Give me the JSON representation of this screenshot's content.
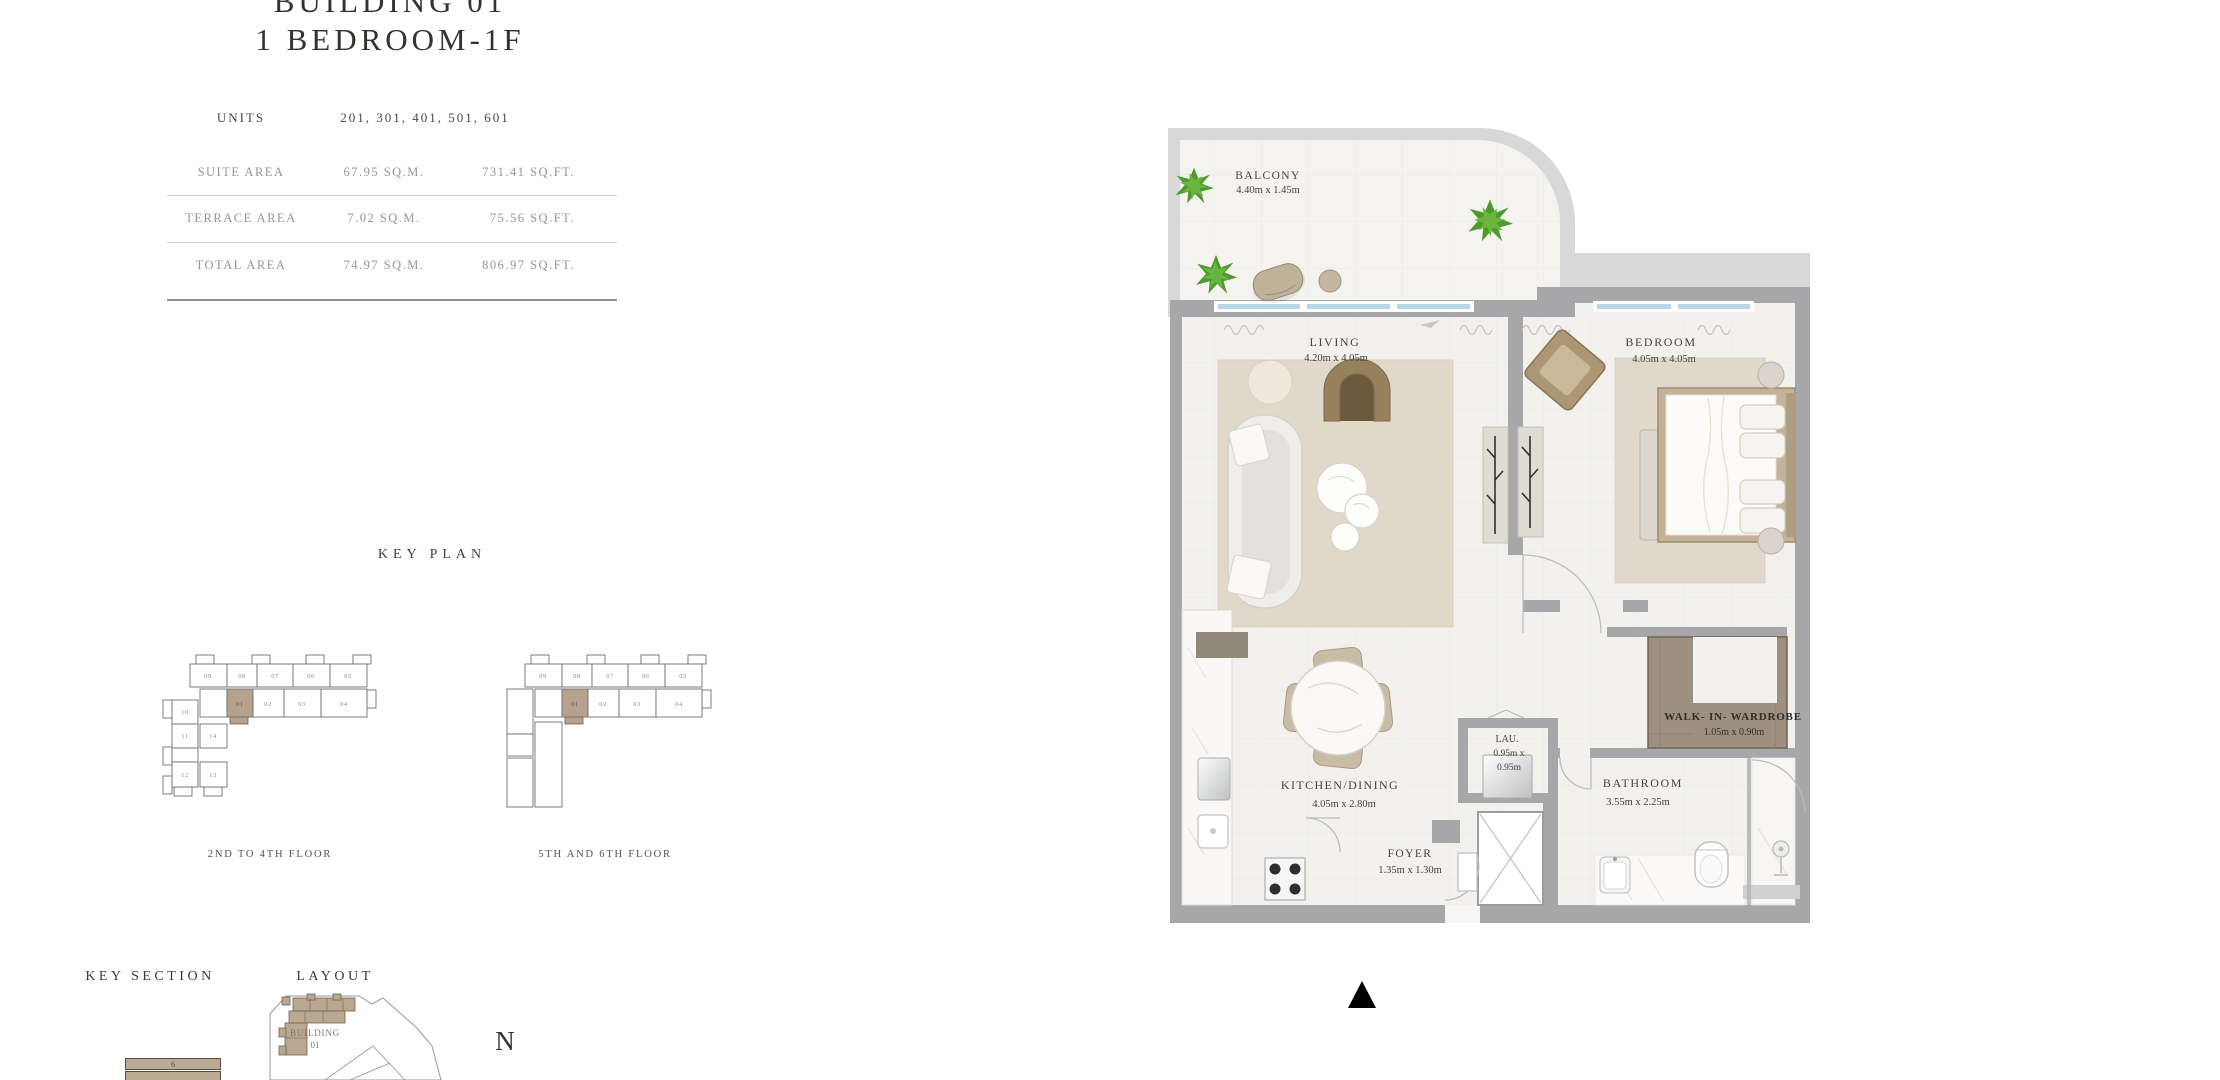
{
  "page": {
    "title_line1": "BUILDING 01",
    "title_line2": "1 BEDROOM-1F",
    "compass": "N"
  },
  "area_table": {
    "units_label": "UNITS",
    "units_value": "201, 301, 401, 501, 601",
    "rows": [
      {
        "label": "SUITE AREA",
        "sqm": "67.95 SQ.M.",
        "sqft": "731.41 SQ.FT."
      },
      {
        "label": "TERRACE AREA",
        "sqm": "7.02 SQ.M.",
        "sqft": "75.56 SQ.FT."
      },
      {
        "label": "TOTAL AREA",
        "sqm": "74.97 SQ.M.",
        "sqft": "806.97 SQ.FT."
      }
    ]
  },
  "key_plan": {
    "title": "KEY PLAN",
    "highlight_color": "#b5a28c",
    "plans": [
      {
        "caption": "2ND TO 4TH FLOOR",
        "top_units": [
          "09",
          "08",
          "07",
          "06",
          "05"
        ],
        "mid_units": [
          "01",
          "02",
          "03",
          "04"
        ],
        "side_units": [
          "10",
          "11",
          "12",
          "14",
          "13"
        ],
        "highlighted_unit": "01"
      },
      {
        "caption": "5TH AND 6TH FLOOR",
        "top_units": [
          "09",
          "08",
          "07",
          "06",
          "05"
        ],
        "mid_units": [
          "01",
          "02",
          "03",
          "04"
        ],
        "highlighted_unit": "01"
      }
    ]
  },
  "key_section": {
    "title": "KEY SECTION",
    "bar_label": "6"
  },
  "layout": {
    "title": "LAYOUT",
    "building_label": "BUILDING",
    "building_number": "01"
  },
  "floor_plan": {
    "rooms": {
      "balcony": {
        "name": "BALCONY",
        "dims": "4.40m x 1.45m"
      },
      "living": {
        "name": "LIVING",
        "dims": "4.20m x 4.05m"
      },
      "bedroom": {
        "name": "BEDROOM",
        "dims": "4.05m x 4.05m"
      },
      "wardrobe": {
        "name": "WALK- IN- WARDROBE",
        "dims": "1.05m x 0.90m"
      },
      "laundry": {
        "name": "LAU.",
        "dims1": "0.95m x",
        "dims2": "0.95m"
      },
      "kitchen": {
        "name": "KITCHEN/DINING",
        "dims": "4.05m x 2.80m"
      },
      "bathroom": {
        "name": "BATHROOM",
        "dims": "3.55m x 2.25m"
      },
      "foyer": {
        "name": "FOYER",
        "dims": "1.35m x 1.30m"
      }
    },
    "colors": {
      "wall": "#a7a7a9",
      "outer_band": "#d8d8d8",
      "floor": "#f2f1ed",
      "window": "#b9d8e5",
      "wardrobe": "#9d9081",
      "rug": "#ded5c5"
    }
  }
}
